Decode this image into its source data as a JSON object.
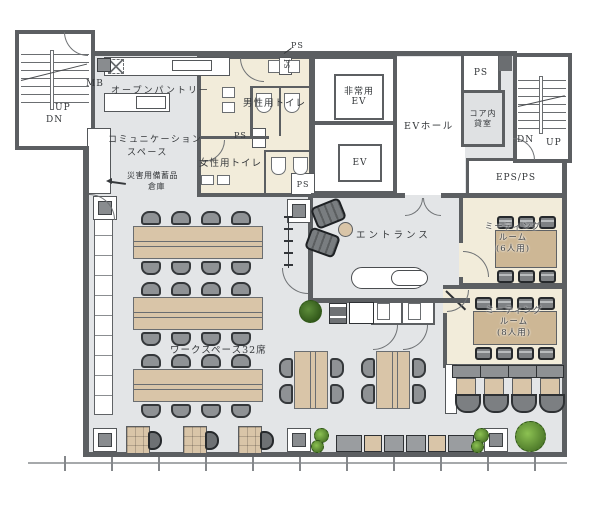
{
  "floorplan": {
    "stairs_left": {
      "up": "UP",
      "dn": "DN"
    },
    "stairs_right": {
      "dn": "DN",
      "up": "UP"
    },
    "pantry": {
      "mb": "MB",
      "label": "オープンパントリー"
    },
    "communication": {
      "line1": "コミュニケーション",
      "line2": "スペース"
    },
    "disaster": {
      "line1": "災害用備蓄品",
      "line2": "倉庫"
    },
    "toilets": {
      "mens": "男性用トイレ",
      "womens": "女性用トイレ"
    },
    "shafts": {
      "ps_top": "PS",
      "ps_small": "PS",
      "ps_mid": "PS",
      "ps_low": "PS",
      "ps_right": "PS",
      "eps": "EPS/PS"
    },
    "elevators": {
      "emergency_line1": "非常用",
      "emergency_line2": "EV",
      "ev": "EV",
      "hall": "EVホール"
    },
    "core_room": {
      "line1": "コア内",
      "line2": "貸室"
    },
    "entrance": {
      "label": "エントランス"
    },
    "meeting6": {
      "line1": "ミーティング",
      "line2": "ルーム",
      "line3": "(6人用)"
    },
    "meeting8": {
      "line1": "ミーティング",
      "line2": "ルーム",
      "line3": "(8人用)"
    },
    "workspace": {
      "label": "ワークスペース32席"
    }
  },
  "colors": {
    "wall": "#5c5f62",
    "floor": "#e3e5e7",
    "cream": "#f2ecda",
    "wood": "#d9c5a8",
    "chair": "#8f9295",
    "ink": "#35383b",
    "door": "#6f7275"
  }
}
